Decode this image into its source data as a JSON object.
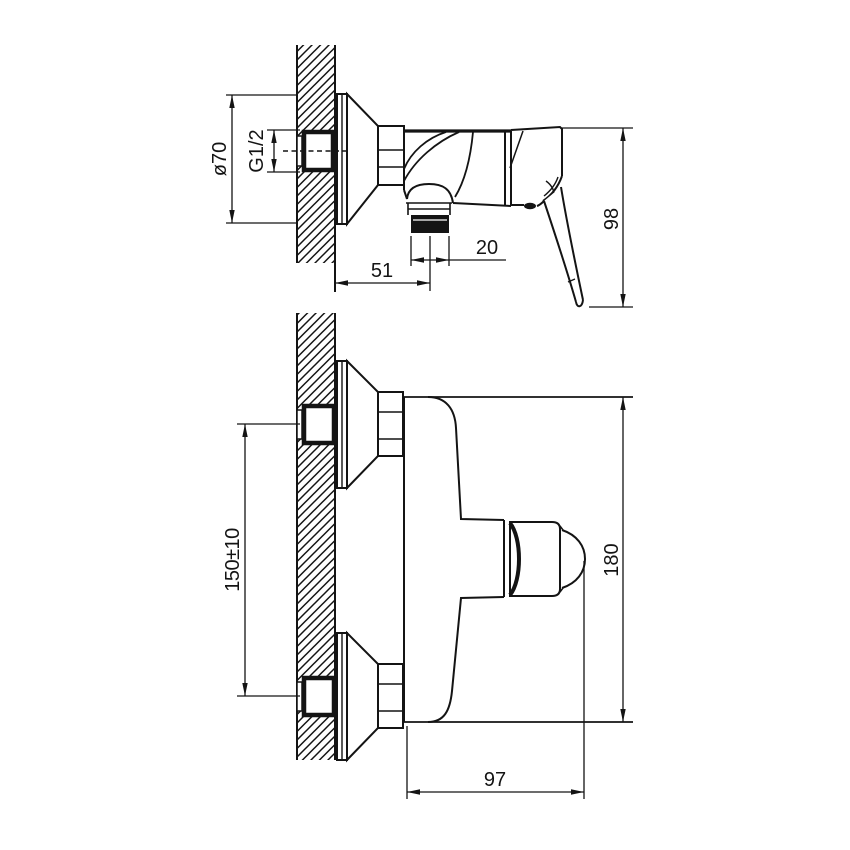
{
  "colors": {
    "background": "#ffffff",
    "line": "#141414"
  },
  "dimensions": {
    "side_view": {
      "escutcheon_diameter": "ø70",
      "inlet_thread_size": "G1/2",
      "wall_to_outlet_center": "51",
      "outlet_thread_width": "20",
      "height_to_handle_tip": "98"
    },
    "front_view": {
      "inlet_spacing": "150±10",
      "overall_height": "180",
      "body_width": "97"
    }
  }
}
